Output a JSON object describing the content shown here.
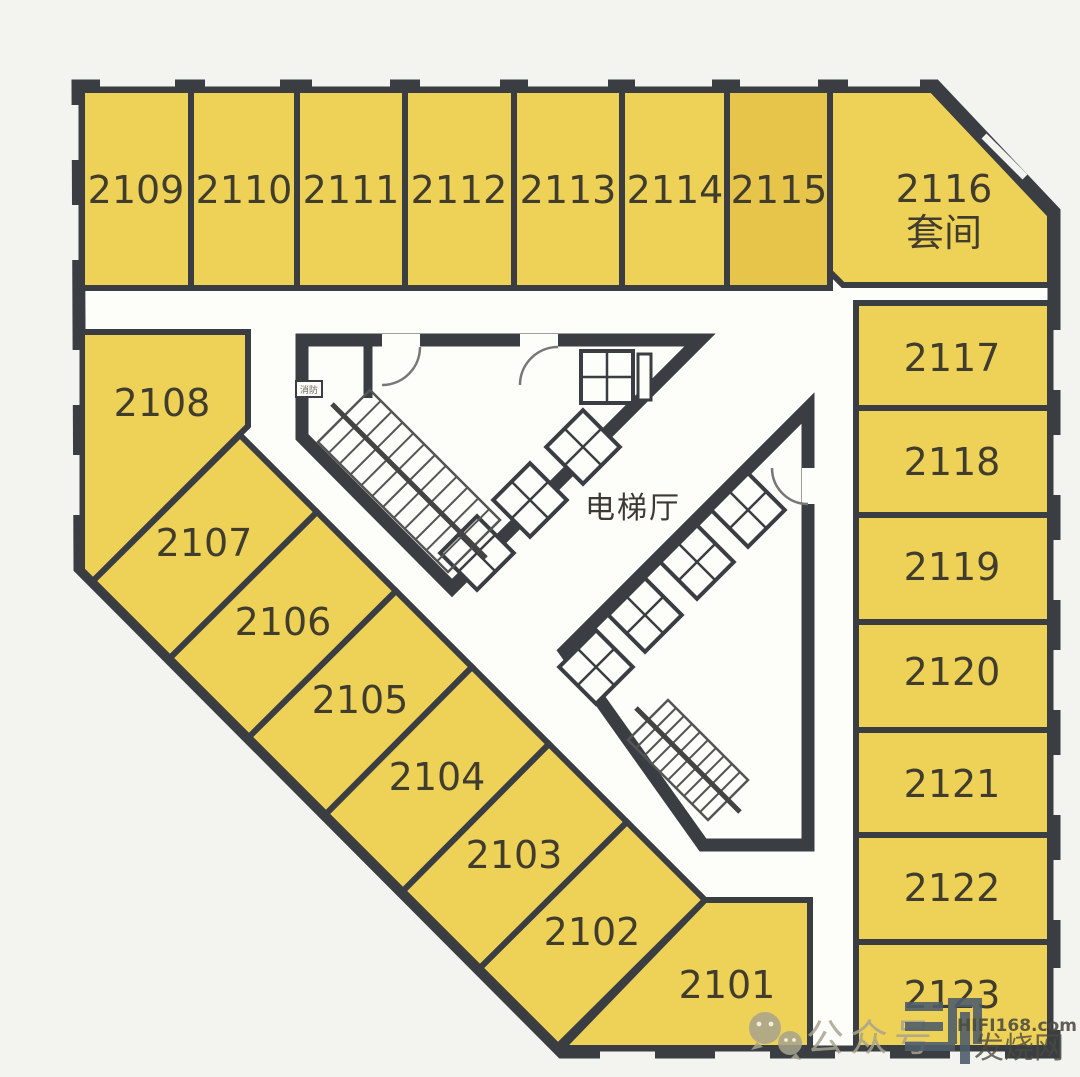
{
  "floorplan": {
    "hall_label": "电梯厅",
    "fire_label": "消防",
    "colors": {
      "room_fill": "#eed157",
      "room_fill_alt": "#e7c54a",
      "wall": "#3a3e43",
      "interior_white": "#fdfdf9",
      "background": "#f3f4f0",
      "label_text": "#413d2e"
    },
    "rooms": [
      {
        "label": "2109",
        "points": "82,90 191,90 191,288 82,288",
        "lx": 136,
        "ly": 203
      },
      {
        "label": "2110",
        "points": "191,90 297,90 297,288 191,288",
        "lx": 244,
        "ly": 203
      },
      {
        "label": "2111",
        "points": "297,90 405,90 405,288 297,288",
        "lx": 351,
        "ly": 203
      },
      {
        "label": "2112",
        "points": "405,90 514,90 514,288 405,288",
        "lx": 459,
        "ly": 203
      },
      {
        "label": "2113",
        "points": "514,90 622,90 622,288 514,288",
        "lx": 568,
        "ly": 203
      },
      {
        "label": "2114",
        "points": "622,90 727,90 727,288 622,288",
        "lx": 675,
        "ly": 203
      },
      {
        "label": "2115",
        "points": "727,90 830,90 830,288 727,288",
        "lx": 779,
        "ly": 203,
        "fill": "alt"
      },
      {
        "label": "2116",
        "label2": "套间",
        "points": "830,90 932,90 1050,215 1050,285 843,285 830,272",
        "lx": 944,
        "ly": 202,
        "ly2": 246
      },
      {
        "label": "2117",
        "points": "856,303 1050,303 1050,408 856,408",
        "lx": 952,
        "ly": 371
      },
      {
        "label": "2118",
        "points": "856,408 1050,408 1050,515 856,515",
        "lx": 952,
        "ly": 475
      },
      {
        "label": "2119",
        "points": "856,515 1050,515 1050,622 856,622",
        "lx": 952,
        "ly": 580
      },
      {
        "label": "2120",
        "points": "856,622 1050,622 1050,730 856,730",
        "lx": 952,
        "ly": 685
      },
      {
        "label": "2121",
        "points": "856,730 1050,730 1050,835 856,835",
        "lx": 952,
        "ly": 797
      },
      {
        "label": "2122",
        "points": "856,835 1050,835 1050,942 856,942",
        "lx": 952,
        "ly": 901
      },
      {
        "label": "2123",
        "points": "856,942 1050,942 1050,1048 856,1048",
        "lx": 952,
        "ly": 1008
      },
      {
        "label": "2108",
        "points": "82,332 248,332 248,426 93,581 82,570",
        "lx": 162,
        "ly": 416
      },
      {
        "label": "2107",
        "points": "93,581 240,435 317,512 170,658",
        "lx": 204,
        "ly": 556
      },
      {
        "label": "2106",
        "points": "170,658 317,512 396,591 249,737",
        "lx": 283,
        "ly": 635
      },
      {
        "label": "2105",
        "points": "249,737 396,591 472,667 326,814",
        "lx": 360,
        "ly": 713
      },
      {
        "label": "2104",
        "points": "326,814 472,667 549,744 403,891",
        "lx": 437,
        "ly": 790
      },
      {
        "label": "2103",
        "points": "403,891 549,744 627,822 480,968",
        "lx": 514,
        "ly": 868
      },
      {
        "label": "2102",
        "points": "480,968 627,822 705,900 558,1046",
        "lx": 592,
        "ly": 945
      },
      {
        "label": "2101",
        "points": "705,900 810,900 810,1048 562,1048",
        "lx": 727,
        "ly": 998
      }
    ]
  },
  "watermark": {
    "wechat_label": "公众号",
    "site_domain": "HIFI168.com",
    "site_name": "发烧网"
  }
}
